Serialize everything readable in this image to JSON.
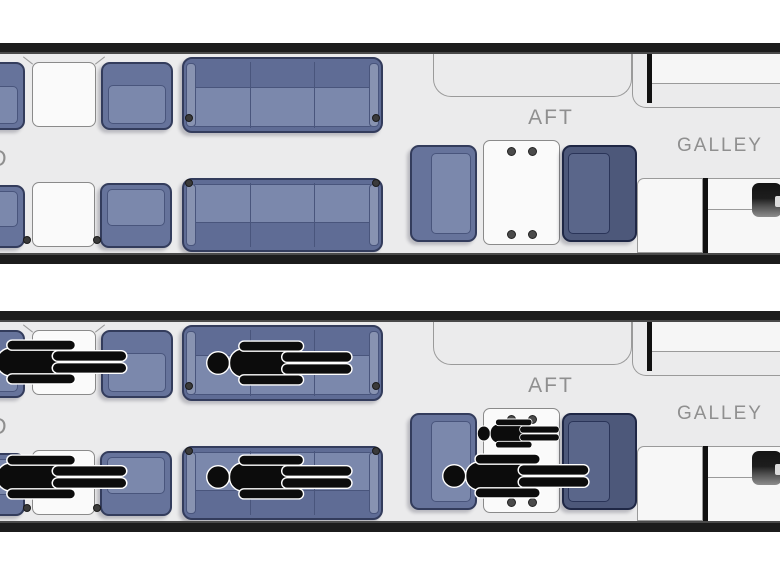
{
  "labels": {
    "aft": "AFT",
    "galley": "GALLEY",
    "fwd_partial": "D"
  },
  "figures": {
    "sleeping_count": 6
  },
  "colors": {
    "floor": "#ebebec",
    "wall": "#1c1c1c",
    "seat_blue": "#66739b",
    "seat_cushion": "#7b88ac",
    "seat_border": "#333c5c",
    "navy_seat": "#4d587a",
    "counter_white": "#f7f7f7",
    "figure_black": "#0c0c0c",
    "label_gray": "#8f8f8f"
  }
}
